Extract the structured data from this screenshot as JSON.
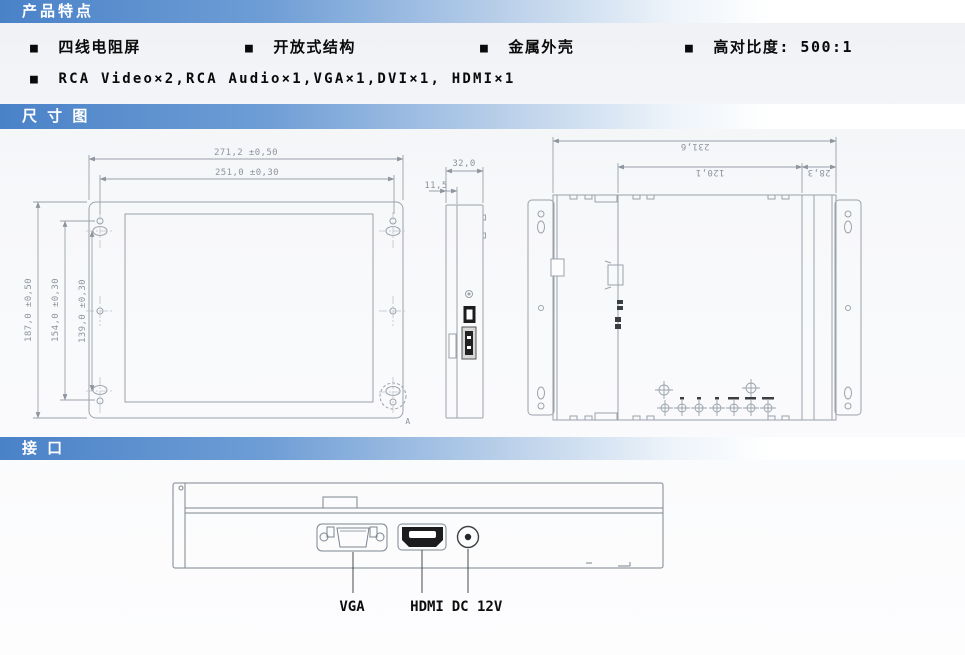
{
  "header_bars": {
    "features_title": "产品特点",
    "dimensions_title": "尺 寸 图",
    "interface_title": "接 口"
  },
  "features": {
    "bullet": "■",
    "items": [
      "四线电阻屏",
      "开放式结构",
      "金属外壳",
      "高对比度: 500:1"
    ],
    "io_line": "RCA Video×2,RCA Audio×1,VGA×1,DVI×1, HDMI×1"
  },
  "dimension_drawing": {
    "front_view": {
      "width_total": "271,2 ±0,50",
      "width_holes": "251,0 ±0,30",
      "height_total": "187,0 ±0,50",
      "height_holes_outer": "154,0 ±0,30",
      "height_holes_inner": "139,0 ±0,30",
      "detail_label": "A"
    },
    "side_view": {
      "depth": "32,0",
      "front_thickness": "11,5"
    },
    "back_view": {
      "width_body": "231,6",
      "width_mid": "120,1",
      "width_right": "28,3",
      "osd_button_count": 7
    }
  },
  "interface_drawing": {
    "ports": [
      "VGA",
      "HDMI",
      "DC 12V"
    ]
  },
  "colors": {
    "accent_blue": "#4a82c8",
    "bar_text": "#ffffff",
    "drawing_line": "#9aa2ab",
    "dark_fill": "#1c1c1e"
  }
}
